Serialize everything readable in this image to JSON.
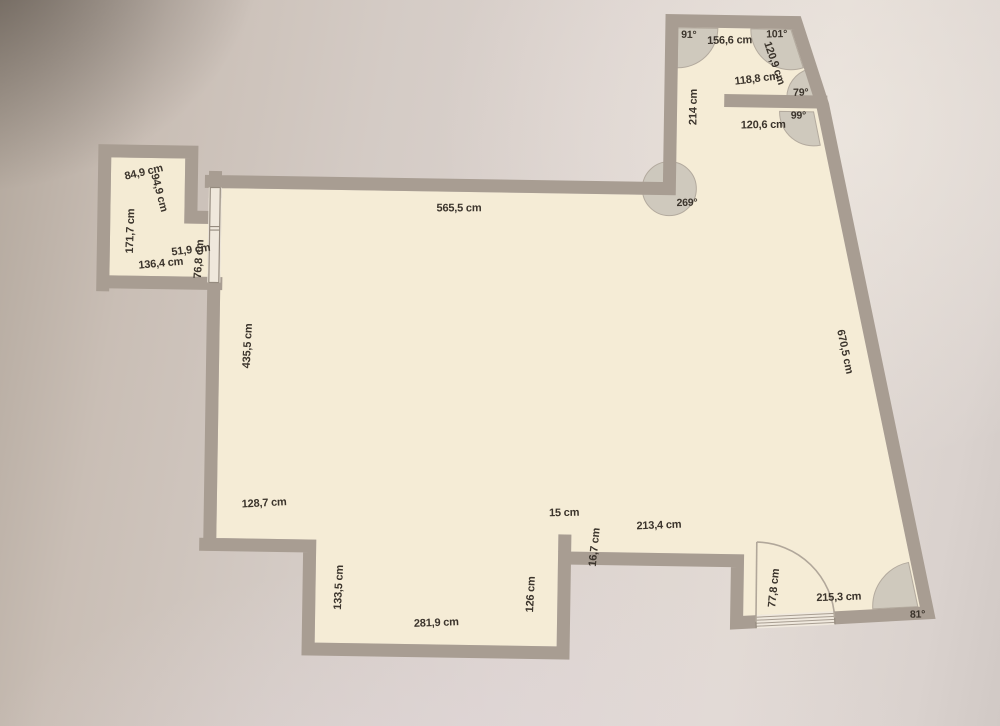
{
  "document": {
    "type": "floor-plan-photo",
    "unit": "cm"
  },
  "colors": {
    "wall": "#a89d92",
    "floor": "#f5ecd6",
    "angle_arc": "#cbc5bb",
    "label_text": "#3b342c",
    "paper_light": "#e2dad4",
    "paper_dark": "#b2a79c"
  },
  "measurements": {
    "top_room_top": "156,6 cm",
    "top_room_right_upper": "120,9 cm",
    "top_room_right_mid": "118,8 cm",
    "top_room_left": "214 cm",
    "top_room_divider": "120,6 cm",
    "main_top": "565,5 cm",
    "annex_top": "84,9 cm",
    "annex_right": "94,9 cm",
    "annex_left": "171,7 cm",
    "annex_notch": "51,9 cm",
    "annex_door": "76,8 cm",
    "annex_bottom": "136,4 cm",
    "main_left": "435,5 cm",
    "right_wall": "670,5 cm",
    "step_wall": "128,7 cm",
    "step_down": "133,5 cm",
    "main_bottom": "281,9 cm",
    "stub_height": "126 cm",
    "stub_width": "15 cm",
    "wall_thickness": "16,7 cm",
    "lower_right_top": "213,4 cm",
    "door_width": "77,8 cm",
    "lower_right_bottom": "215,3 cm"
  },
  "angles": {
    "a91": "91°",
    "a101": "101°",
    "a79": "79°",
    "a99": "99°",
    "a269": "269°",
    "a81": "81°"
  }
}
